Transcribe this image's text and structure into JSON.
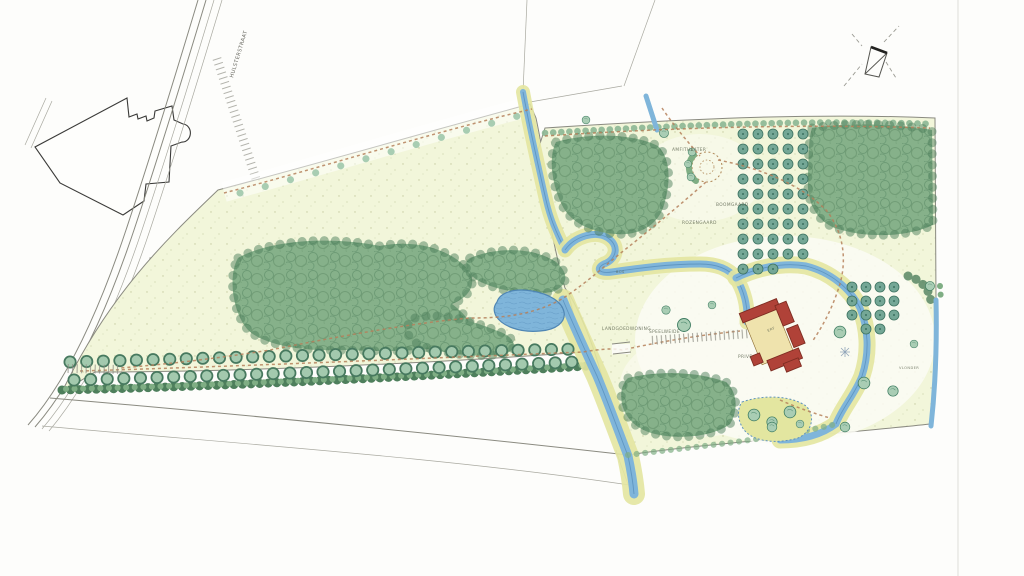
{
  "labels": {
    "road": "HULSTERSTRAAT",
    "amphitheater": "AMFITHEATER",
    "orchard": "BOOMGAARD",
    "rose_garden": "ROZENGAARD",
    "estate_house": "LANDGOEDWONING",
    "play_meadow": "SPEELWEIDE",
    "private": "PRIVE",
    "forest": "BOS",
    "yard": "ERF",
    "deck": "VLONDER"
  },
  "icons": {
    "north_arrow": "north-arrow-icon"
  },
  "palette": {
    "paper": "#fdfdfb",
    "parcel": "#f2f6da",
    "woodland": "#86b18a",
    "woodland_dark": "#4e7f5c",
    "avenue_tree": "#a3c9ae",
    "orchard_tree": "#74a796",
    "water": "#7fb5da",
    "water_edge": "#4f86b4",
    "reed": "#e3e6a0",
    "path": "#b5805a",
    "roof": "#b04238",
    "courtyard": "#efe3ad",
    "pen_line": "#8a8a80",
    "building_outline": "#3a3a38"
  }
}
